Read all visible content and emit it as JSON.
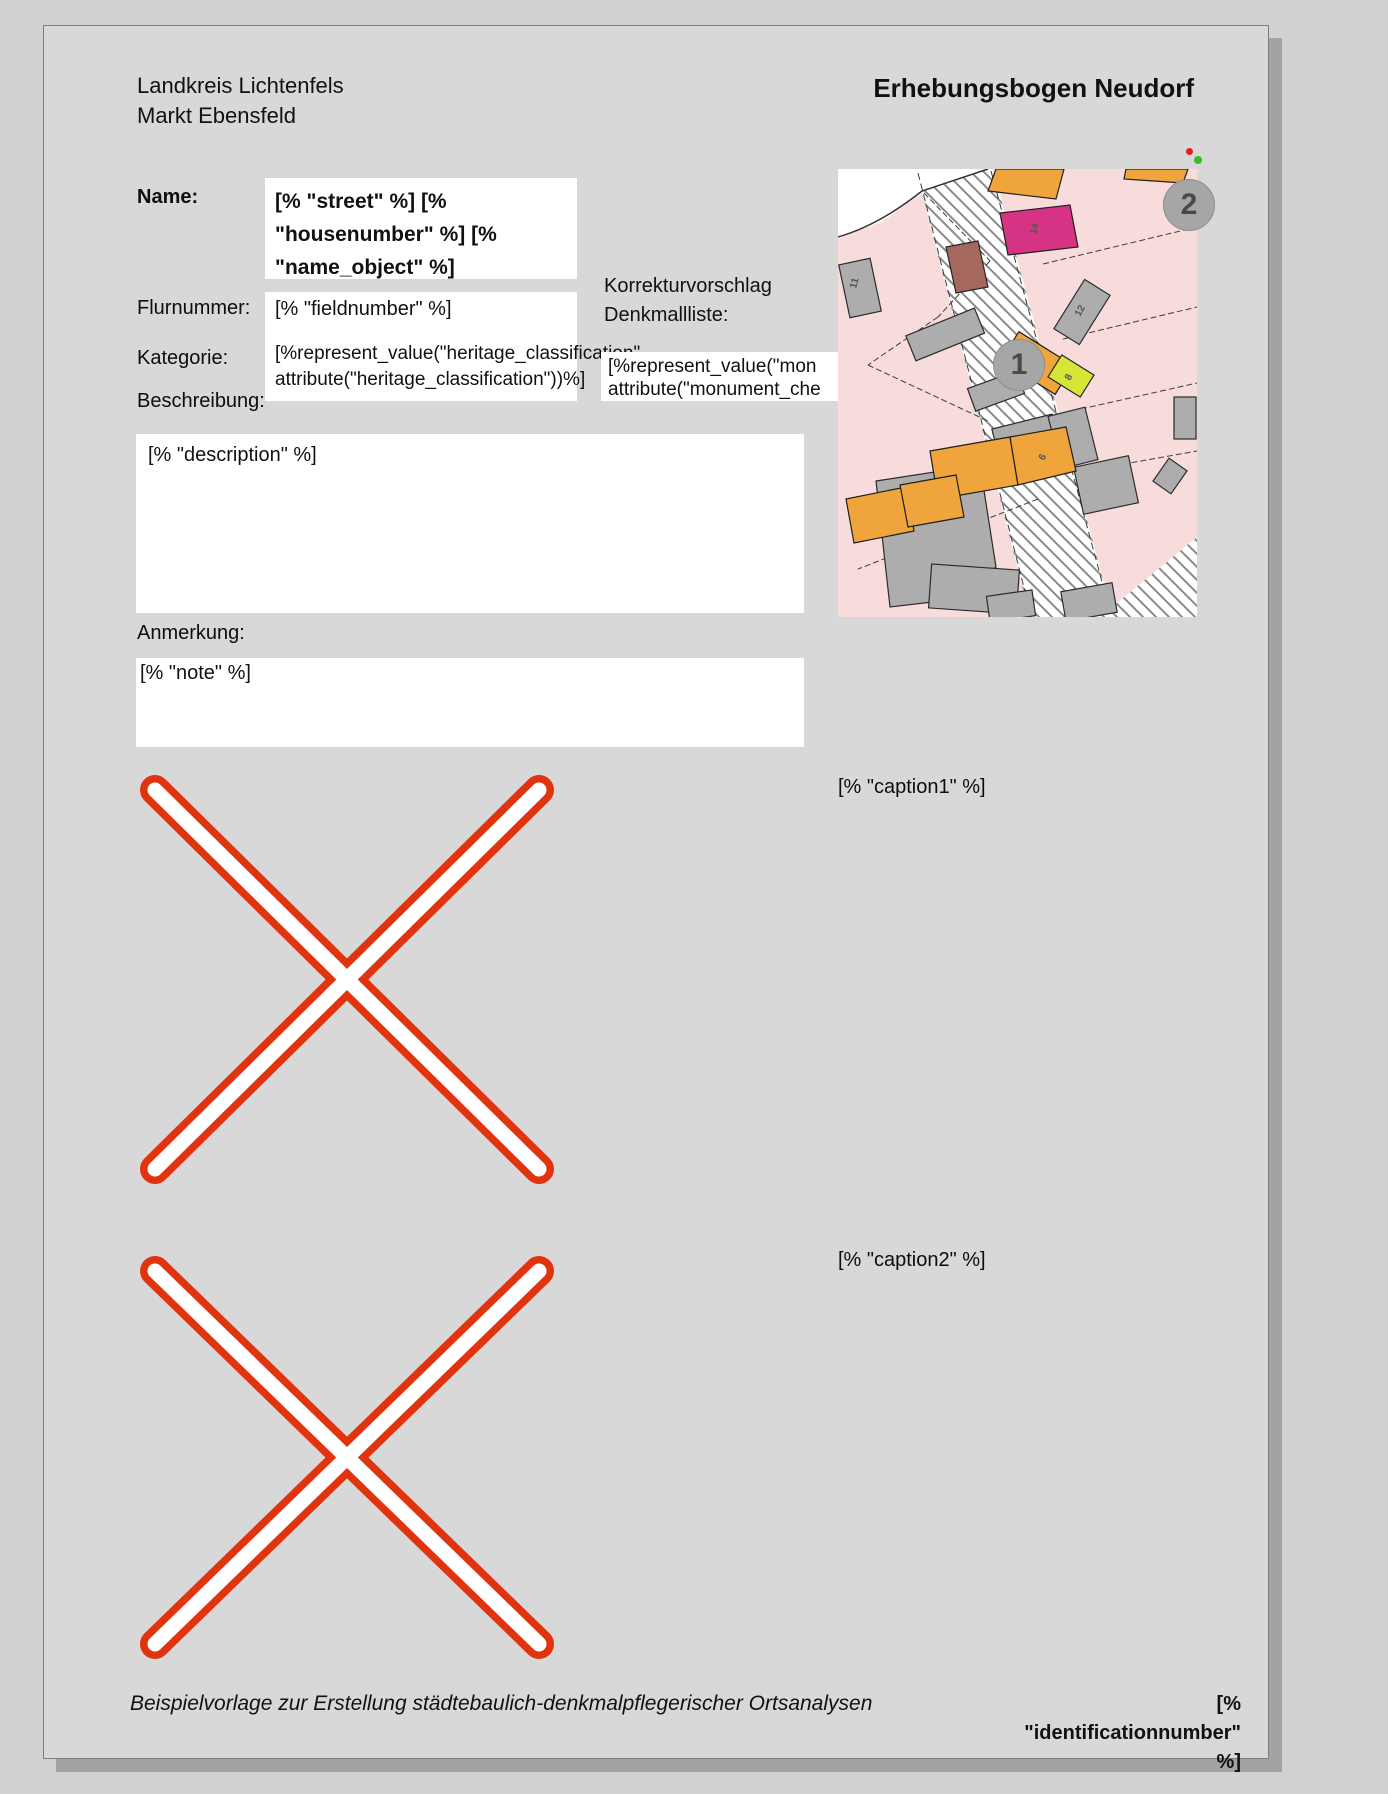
{
  "header": {
    "org_line1": "Landkreis Lichtenfels",
    "org_line2": "Markt Ebensfeld",
    "title": "Erhebungsbogen Neudorf"
  },
  "form": {
    "name": {
      "label": "Name:",
      "lines": [
        "[% \"street\" %] [%",
        "\"housenumber\" %] [%",
        "\"name_object\" %]"
      ]
    },
    "fieldnumber": {
      "label": "Flurnummer:",
      "value": "[% \"fieldnumber\" %]"
    },
    "category": {
      "label": "Kategorie:",
      "lines": [
        "[%represent_value(\"heritage_classification\",",
        "attribute(\"heritage_classification\"))%]"
      ]
    },
    "correction": {
      "label_lines": [
        "Korrekturvorschlag",
        "Denkmallliste:"
      ],
      "lines": [
        "[%represent_value(\"mon",
        "attribute(\"monument_che"
      ]
    },
    "description": {
      "label": "Beschreibung:",
      "value": "[% \"description\" %]"
    },
    "note": {
      "label": "Anmerkung:",
      "value": "[% \"note\" %]"
    }
  },
  "images": {
    "caption1": "[% \"caption1\" %]",
    "caption2": "[% \"caption2\" %]"
  },
  "map": {
    "marker1": "1",
    "marker2": "2",
    "house_numbers": {
      "h11": "11",
      "h14": "14",
      "h12": "12",
      "h10": "10",
      "h8": "8",
      "h6": "6"
    }
  },
  "footer": {
    "note": "Beispielvorlage zur Erstellung städtebaulich-denkmalpflegerischer Ortsanalysen",
    "identification_lines": [
      "[%",
      "\"identificationnumber\"",
      "%]"
    ]
  },
  "colors": {
    "canvas_bg": "#d1d1d1",
    "page_bg": "#d8d8d8",
    "field_bg": "#ffffff",
    "missing_image_red": "#e2330f",
    "map_parcel_pink": "#f8dcdc",
    "map_building_gray": "#adadad",
    "map_building_orange": "#efa53b",
    "map_building_magenta": "#d63384",
    "map_building_darkred": "#a5685f",
    "map_building_yellowgreen": "#d5e636"
  }
}
